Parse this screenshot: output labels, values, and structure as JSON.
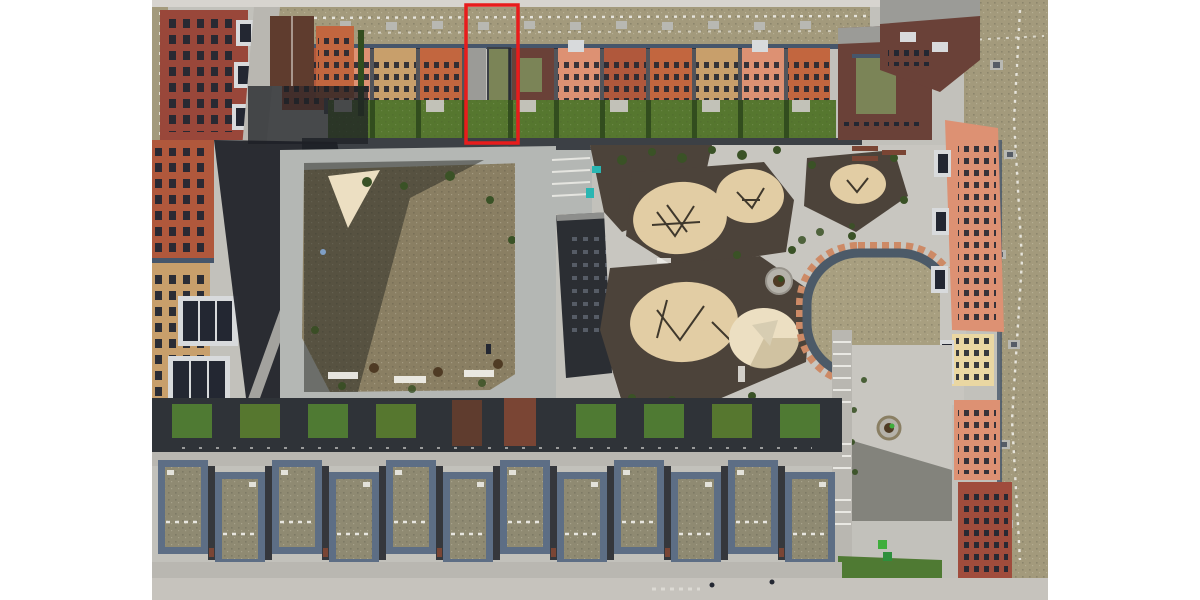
{
  "scene": {
    "type": "aerial-drone-photograph",
    "subject": "residential housing block with inner courtyard, dirt lawn, sand playgrounds, oval dry lawn and green-roof townhouse rows",
    "visible_text": ""
  },
  "annotation": {
    "shape": "rectangle",
    "color": "#e81c1c",
    "purpose": "highlights one townhouse unit in the upper row"
  },
  "palette": {
    "margin": "#ffffff",
    "topstrip": "#d7d4cf",
    "concrete": "#c2c1bb",
    "concrete2": "#c8c6c0",
    "concrete3": "#b5b2aa",
    "walklight": "#b9b7b1",
    "walkdark": "#3c4045",
    "boardwalk": "#b4b7b4",
    "dirt": "#8a7f63",
    "sand": "#e2cda4",
    "sandlight": "#ecdfc2",
    "sandshade": "#cbbd9b",
    "mulch": "#4c433a",
    "grass": "#56772f",
    "grassbright": "#4f7a33",
    "grassdark": "#324d1e",
    "grassoliv": "#7b8457",
    "grassdry": "#a89f80",
    "roofgreen": "#a39a7c",
    "roofoliv": "#8f8a72",
    "roofgray": "#9b9b97",
    "roofdark": "#2b2e33",
    "parapet": "#5d6e85",
    "parapetdark": "#46566b",
    "shadowdeep": "#1d2026",
    "shadowband": "#2f3338",
    "brick": "#99473a",
    "brickdark": "#6a4138",
    "red": "#b0583c",
    "red2": "#a04c3c",
    "orange": "#c2663f",
    "salmon": "#dd9173",
    "tanfacade": "#c89f6b",
    "yellow": "#ead7a2",
    "woodroof": "#5f3c2e",
    "wood2": "#7a4534",
    "windowdark": "#232732",
    "balcony": "#d8dadc",
    "white": "#f2f1ec",
    "sky": "#b8b8b2",
    "skydot": "#565c66",
    "teal": "#2ab6b2",
    "blue": "#7f9fc6",
    "treedark": "#3a5226",
    "treebrown": "#4f3b24",
    "green": "#3fae3c",
    "green2": "#2e8f3c",
    "ringdark": "#4c5a68",
    "brickring": "#cd8a66",
    "framewood": "#3f382c",
    "street": "#c6c3bd"
  }
}
